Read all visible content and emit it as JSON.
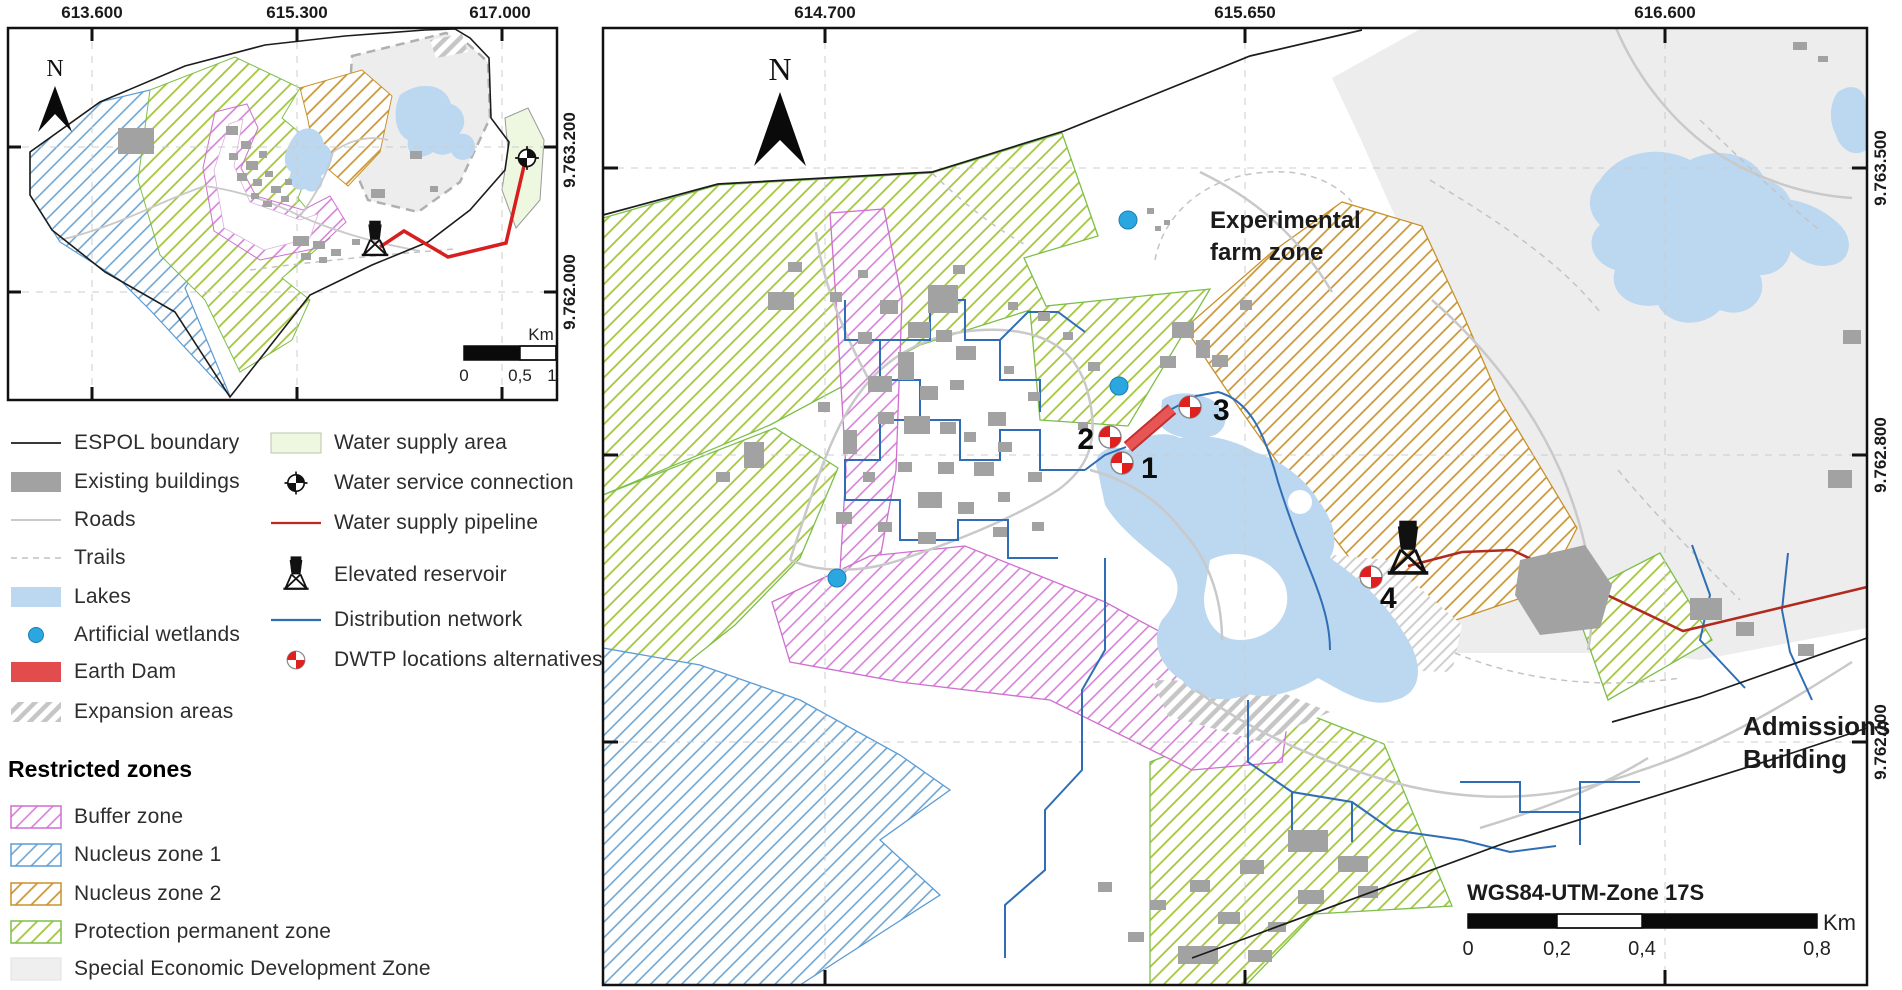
{
  "inset_map": {
    "north_label": "N",
    "x_labels": [
      "613.600",
      "615.300",
      "617.000"
    ],
    "y_labels": [
      "9.763.200",
      "9.762.000"
    ],
    "scale": {
      "ticks": [
        "0",
        "0,5",
        "1"
      ],
      "unit": "Km"
    }
  },
  "main_map": {
    "north_label": "N",
    "x_labels": [
      "614.700",
      "615.650",
      "616.600"
    ],
    "y_labels": [
      "9.763.500",
      "9.762.800",
      "9.762.100"
    ],
    "labels": {
      "experimental_farm_line1": "Experimental",
      "experimental_farm_line2": "farm zone",
      "admissions_line1": "Admissions",
      "admissions_line2": "Building",
      "crs": "WGS84-UTM-Zone 17S"
    },
    "scale": {
      "ticks": [
        "0",
        "0,2",
        "0,4",
        "0,8"
      ],
      "unit": "Km"
    },
    "dwtp_markers": [
      "1",
      "2",
      "3",
      "4"
    ]
  },
  "legend": {
    "col1": [
      {
        "label": "ESPOL boundary"
      },
      {
        "label": "Existing buildings"
      },
      {
        "label": "Roads"
      },
      {
        "label": "Trails"
      },
      {
        "label": "Lakes"
      },
      {
        "label": "Artificial wetlands"
      },
      {
        "label": "Earth Dam"
      },
      {
        "label": "Expansion areas"
      }
    ],
    "col2": [
      {
        "label": "Water supply area"
      },
      {
        "label": "Water service connection"
      },
      {
        "label": "Water supply pipeline"
      },
      {
        "label": "Elevated reservoir"
      },
      {
        "label": "Distribution network"
      },
      {
        "label": "DWTP locations alternatives"
      }
    ],
    "restricted_title": "Restricted zones",
    "restricted": [
      {
        "label": "Buffer zone"
      },
      {
        "label": "Nucleus zone 1"
      },
      {
        "label": "Nucleus zone 2"
      },
      {
        "label": "Protection permanent zone"
      },
      {
        "label": "Special Economic Development Zone"
      }
    ]
  },
  "colors": {
    "buffer_zone": "#cf6fd1",
    "nucleus_zone_1": "#5b9bd5",
    "nucleus_zone_2": "#c8922a",
    "protection_permanent_zone": "#8fbf3f",
    "special_economic_zone": "#ededed",
    "lakes": "#bcd7f0",
    "buildings": "#a2a2a2",
    "pipeline": "#b02a1e",
    "distribution_network": "#2f6eb5",
    "earth_dam": "#e34c4c",
    "artificial_wetland": "#2aa7e0",
    "water_supply_area": "#eef7e0"
  }
}
